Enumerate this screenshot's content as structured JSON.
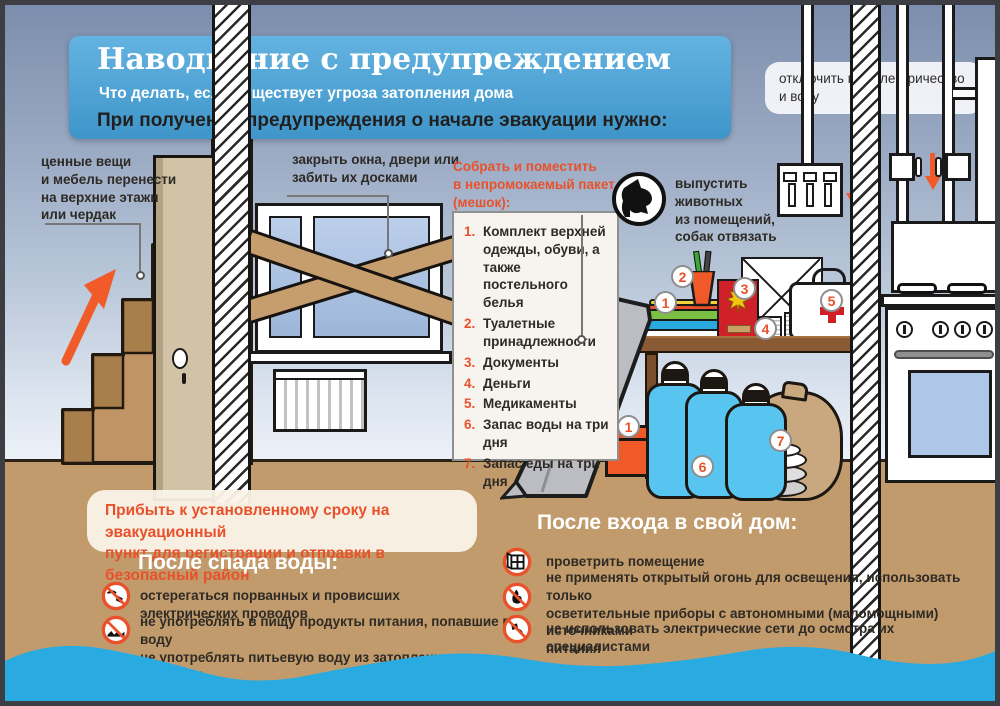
{
  "header": {
    "title": "Наводнение с предупреждением",
    "subtitle": "Что делать, если существует угроза затопления дома",
    "instruction": "При получении предупреждения о начале эвакуации нужно:"
  },
  "callouts": {
    "utilities": "отключить газ, электричество\nи воду",
    "valuables": "ценные вещи\nи мебель перенести\nна верхние этажи\nили чердак",
    "windows": "закрыть окна, двери или\nзабить их досками",
    "animals": "выпустить\nживотных\nиз помещений,\nсобак отвязать"
  },
  "pack": {
    "heading": "Собрать и поместить\nв непромокаемый пакет\n(мешок):",
    "items": [
      {
        "num": "1.",
        "text": "Комплект верхней одежды, обуви, а также постельного белья"
      },
      {
        "num": "2.",
        "text": "Туалетные принадлежности"
      },
      {
        "num": "3.",
        "text": "Документы"
      },
      {
        "num": "4.",
        "text": "Деньги"
      },
      {
        "num": "5.",
        "text": "Медикаменты"
      },
      {
        "num": "6.",
        "text": "Запас воды на три дня"
      },
      {
        "num": "7.",
        "text": "Запас еды на три дня"
      }
    ]
  },
  "markers": {
    "clothes": "1",
    "toiletries": "2",
    "documents": "3",
    "money": "4",
    "medkit": "5",
    "box": "1",
    "water": "6",
    "food": "7"
  },
  "evacuation_note": "Прибыть к установленному сроку на эвакуационный\nпункт для регистрации и отправки в безопасный район",
  "after_water": {
    "heading": "После спада воды:",
    "items": [
      "остерегаться порванных и провисших электрических проводов",
      "не употреблять в пищу продукты питания, попавшие в воду\nне употреблять питьевую воду из затопленных колодцев"
    ]
  },
  "after_entry": {
    "heading": "После входа в свой дом:",
    "items": [
      "проветрить помещение",
      "не применять открытый огонь для освещения, использовать только\nосветительные приборы с автономными (маломощными) источниками\nпитания",
      "не использовать электрические сети до осмотра их специалистами"
    ]
  },
  "icons": {
    "dog": "released-animals",
    "no_wires": "beware-broken-wires",
    "no_food_water": "no-flooded-food-or-well-water",
    "ventilate": "ventilate-room",
    "no_open_fire": "no-open-fire",
    "no_electric": "no-electric-network"
  },
  "colors": {
    "accent": "#e8512a",
    "header_bg": "#4ba3d8",
    "water": "#29abe2",
    "ground": "#c19b6c",
    "arrow": "#f15a29"
  }
}
